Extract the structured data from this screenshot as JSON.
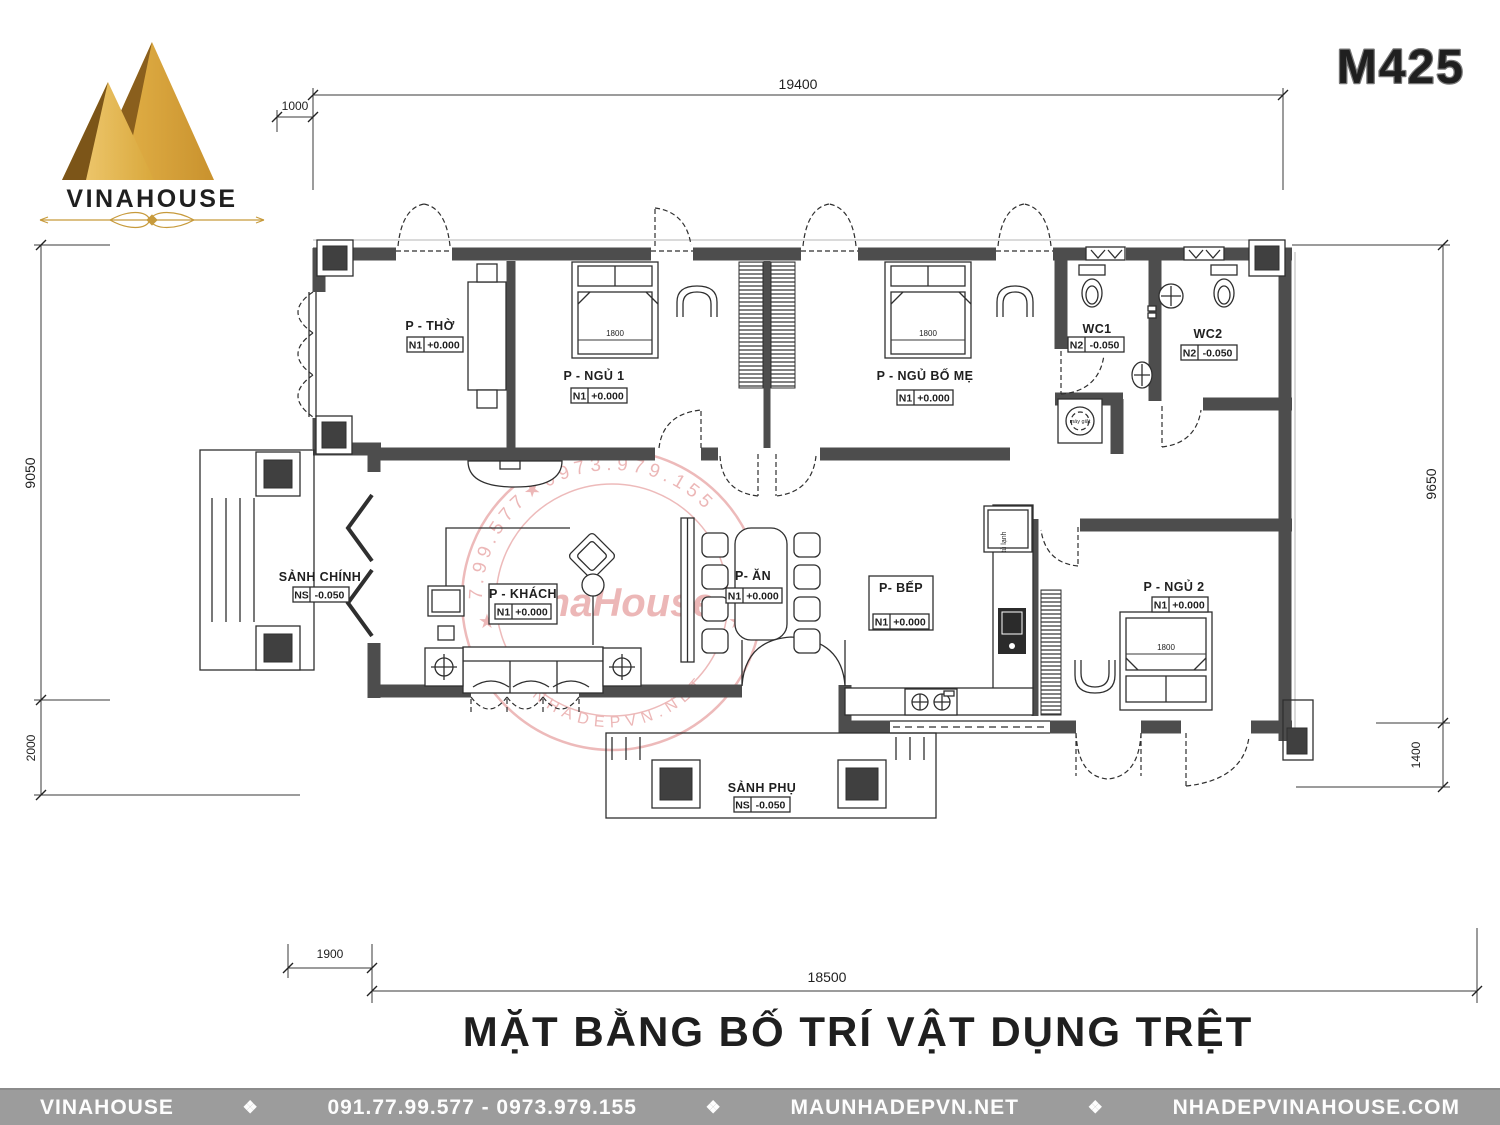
{
  "model_code": "M425",
  "logo": {
    "brand": "VINAHOUSE"
  },
  "plan_title": "MẶT BẰNG BỐ TRÍ VẬT DỤNG TRỆT",
  "watermark": {
    "arc_top": "7.99.577★0973.979.155",
    "arc_bottom": "MAUNHADEPVN.NET",
    "name": "VinaHouse",
    "star": "★"
  },
  "dimensions": {
    "top_width": "19400",
    "top_offset": "1000",
    "left_height": "9050",
    "left_porch": "2000",
    "right_height": "9650",
    "right_offset": "1400",
    "bottom_offset": "1900",
    "bottom_width": "18500"
  },
  "rooms": {
    "tho": {
      "name": "P - THỜ",
      "level_tag": "N1",
      "level": "+0.000"
    },
    "ngu1": {
      "name": "P - NGỦ 1",
      "level_tag": "N1",
      "level": "+0.000"
    },
    "ngu_bo_me": {
      "name": "P - NGỦ BỐ MẸ",
      "level_tag": "N1",
      "level": "+0.000"
    },
    "wc1": {
      "name": "WC1",
      "level_tag": "N2",
      "level": "-0.050"
    },
    "wc2": {
      "name": "WC2",
      "level_tag": "N2",
      "level": "-0.050"
    },
    "sanh_chinh": {
      "name": "SẢNH CHÍNH",
      "level_tag": "NS",
      "level": "-0.050"
    },
    "khach": {
      "name": "P - KHÁCH",
      "level_tag": "N1",
      "level": "+0.000"
    },
    "an": {
      "name": "P- ĂN",
      "level_tag": "N1",
      "level": "+0.000"
    },
    "bep": {
      "name": "P- BẾP",
      "level_tag": "N1",
      "level": "+0.000"
    },
    "ngu2": {
      "name": "P - NGỦ 2",
      "level_tag": "N1",
      "level": "+0.000"
    },
    "sanh_phu": {
      "name": "SẢNH PHỤ",
      "level_tag": "NS",
      "level": "-0.050"
    }
  },
  "furniture": {
    "bed_ngu1": "1800",
    "bed_bo_me": "1800",
    "bed_ngu2": "1800",
    "fridge": "tủ lạnh",
    "washer": "máy giặt"
  },
  "footer": {
    "brand": "VINAHOUSE",
    "phone": "091.77.99.577 - 0973.979.155",
    "site_primary": "MAUNHADEPVN.NET",
    "site_secondary": "NHADEPVINAHOUSE.COM",
    "separator": "❖"
  },
  "colors": {
    "wall": "#4d4d4d",
    "gold": "#c79a3b",
    "watermark_red": "#cf4545",
    "footer_bg": "#9c9c9c"
  }
}
